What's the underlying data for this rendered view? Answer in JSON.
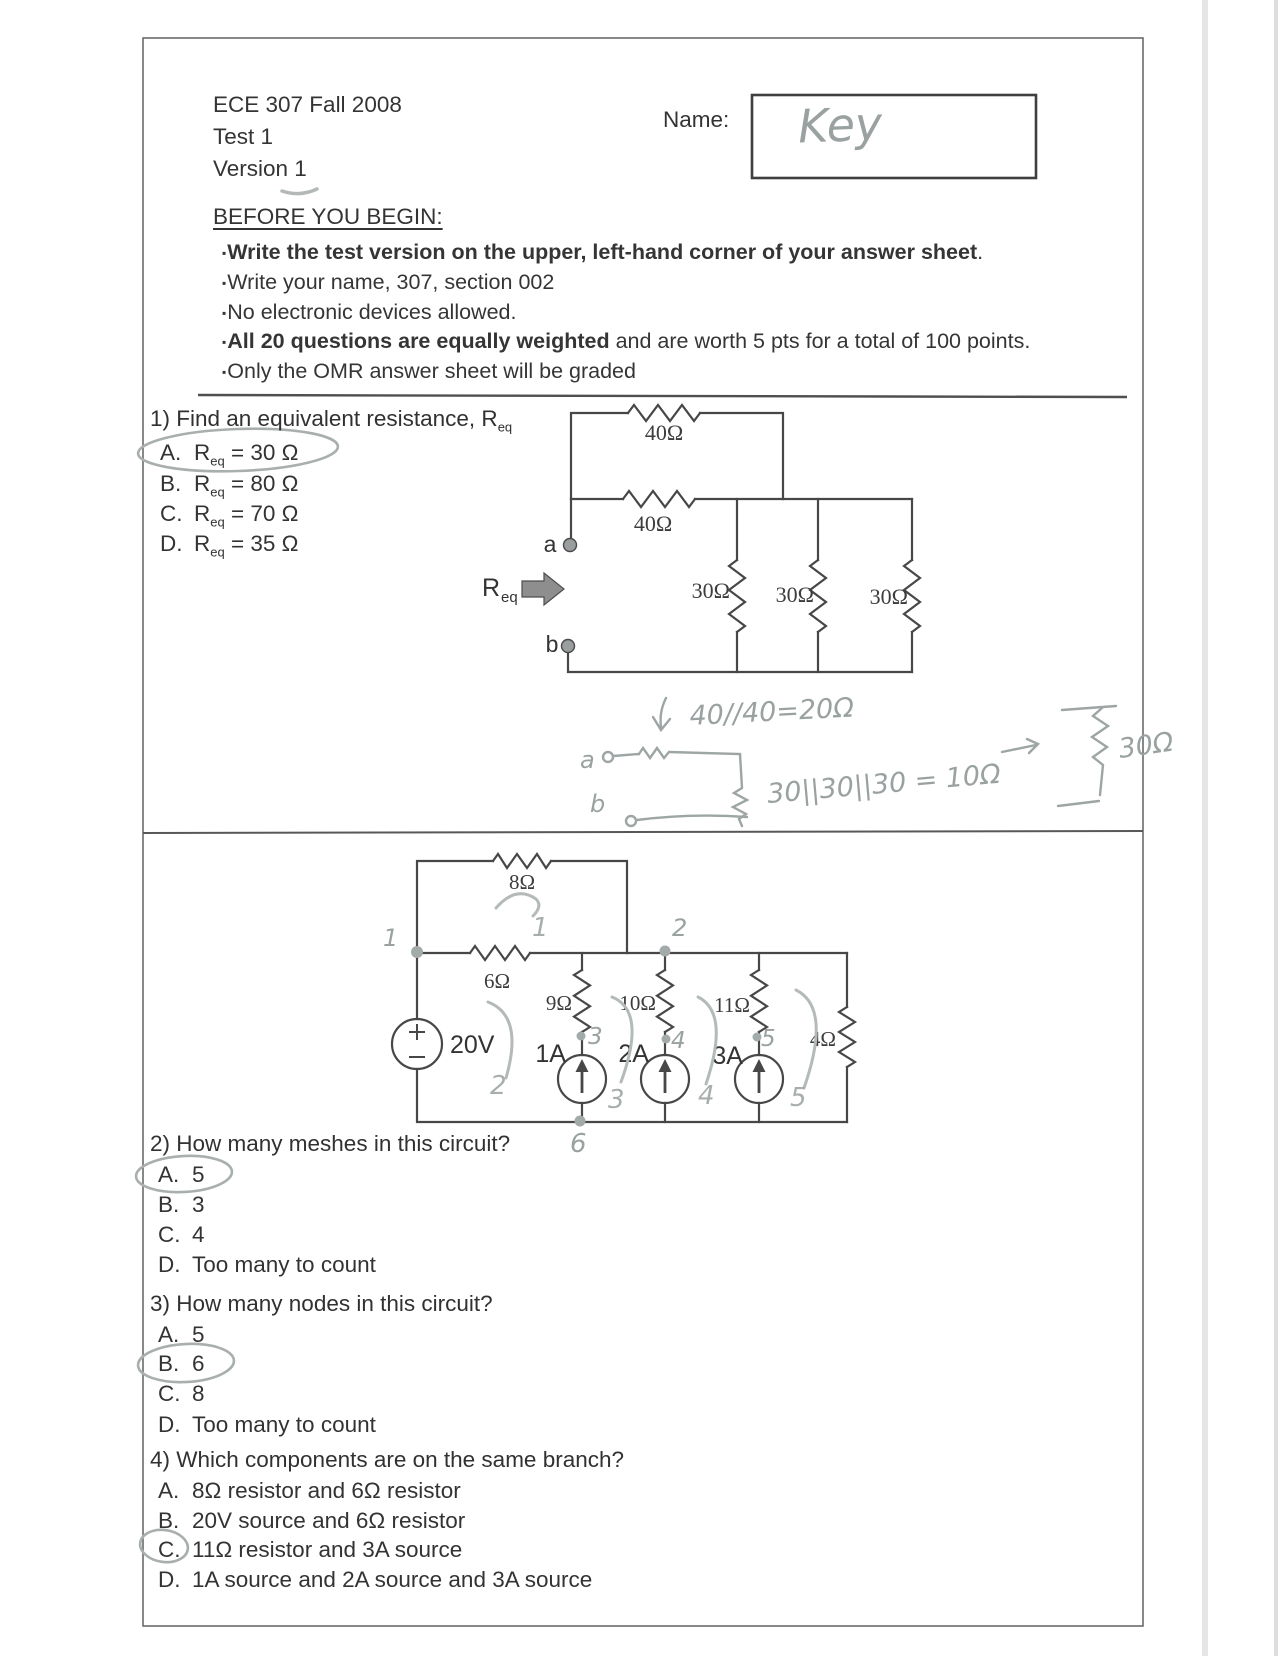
{
  "header": {
    "course": "ECE 307  Fall 2008",
    "test": "Test 1",
    "version": "Version 1",
    "name_label": "Name:",
    "name_value": "Key"
  },
  "instructions": {
    "heading": "BEFORE YOU BEGIN:",
    "bullet_char": "▪",
    "bullets": [
      {
        "bold": "Write the test version on the upper, left-hand corner of your answer sheet",
        "rest": "."
      },
      {
        "bold": "",
        "rest": "Write your name, 307, section 002"
      },
      {
        "bold": "",
        "rest": "No electronic devices allowed."
      },
      {
        "bold": "All 20 questions are equally weighted",
        "rest": " and are worth 5 pts for a total of 100 points."
      },
      {
        "bold": "",
        "rest": "Only the OMR answer sheet will be graded"
      }
    ]
  },
  "q1": {
    "text": "1) Find an equivalent resistance, R",
    "text_sub": "eq",
    "options": [
      {
        "letter": "A.",
        "r": "R",
        "sub": "eq",
        "value": " =  30 Ω"
      },
      {
        "letter": "B.",
        "r": "R",
        "sub": "eq",
        "value": " = 80 Ω"
      },
      {
        "letter": "C.",
        "r": "R",
        "sub": "eq",
        "value": " = 70 Ω"
      },
      {
        "letter": "D.",
        "r": "R",
        "sub": "eq",
        "value": " = 35 Ω"
      }
    ],
    "circled": "A"
  },
  "circuit1": {
    "r_top": "40Ω",
    "r_mid": "40Ω",
    "r_parallel": [
      "30Ω",
      "30Ω",
      "30Ω"
    ],
    "terminal_a": "a",
    "terminal_b": "b",
    "req": "R",
    "req_sub": "eq"
  },
  "handwork": {
    "line1": "40//40=20Ω",
    "a": "a",
    "line2": "30||30||30 = 10Ω",
    "b": "b",
    "result": "30Ω"
  },
  "circuit2": {
    "r8": "8Ω",
    "r6": "6Ω",
    "r9": "9Ω",
    "r10": "10Ω",
    "r11": "11Ω",
    "r4": "4Ω",
    "v20": "20V",
    "i1": "1A",
    "i2": "2A",
    "i3": "3A",
    "node_numbers": [
      "1",
      "2",
      "3",
      "4",
      "5",
      "6"
    ],
    "mesh_numbers": [
      "1",
      "2",
      "3",
      "4",
      "5"
    ]
  },
  "q2": {
    "text": "2) How many meshes in this circuit?",
    "options": [
      {
        "letter": "A.",
        "value": "5"
      },
      {
        "letter": "B.",
        "value": "3"
      },
      {
        "letter": "C.",
        "value": "4"
      },
      {
        "letter": "D.",
        "value": "Too many to count"
      }
    ],
    "circled": "A"
  },
  "q3": {
    "text": "3) How many nodes in this circuit?",
    "options": [
      {
        "letter": "A.",
        "value": "5"
      },
      {
        "letter": "B.",
        "value": "6"
      },
      {
        "letter": "C.",
        "value": "8"
      },
      {
        "letter": "D.",
        "value": "Too many to count"
      }
    ],
    "circled": "B"
  },
  "q4": {
    "text": "4) Which components are on the same branch?",
    "options": [
      {
        "letter": "A.",
        "value": "8Ω resistor and 6Ω resistor"
      },
      {
        "letter": "B.",
        "value": "20V source and 6Ω resistor"
      },
      {
        "letter": "C.",
        "value": "11Ω resistor and 3A source"
      },
      {
        "letter": "D.",
        "value": "1A source and 2A source and 3A source"
      }
    ],
    "circled": "C"
  }
}
